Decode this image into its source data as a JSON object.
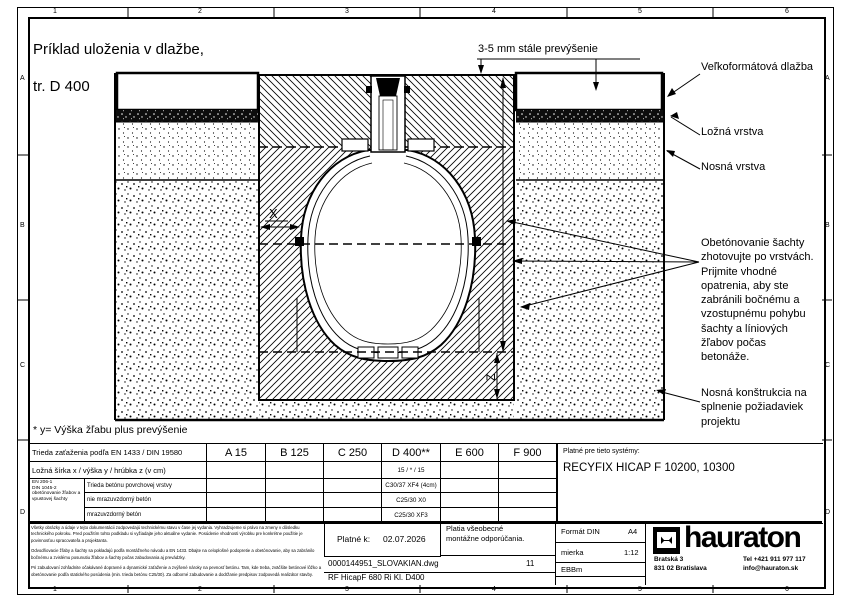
{
  "frame": {
    "cols": [
      "1",
      "2",
      "3",
      "4",
      "5",
      "6"
    ],
    "rows": [
      "A",
      "B",
      "C",
      "D"
    ]
  },
  "title": {
    "line1": "Príklad uloženia v dlažbe,",
    "line2": "tr. D 400"
  },
  "annotations": {
    "overhang": "3-5 mm stále prevýšenie",
    "paving": "Veľkoformátová dlažba",
    "bedding": "Ložná vrstva",
    "base_layer": "Nosná vrstva",
    "encasement": "Obetónovanie šachty\nzhotovujte po vrstvách.\nPrijmite vhodné\nopatrenia, aby ste\nzabránili bočnému a\nvzostupnému pohybu\nšachty a líniových\nžľabov počas\nbetonáže.",
    "substructure": "Nosná konštrukcia na\nsplnenie požiadaviek\nprojektu",
    "dim_x": "X",
    "dim_z": "Z",
    "footnote": "* y= Výška žľabu plus prevýšenie"
  },
  "table": {
    "load_class_label": "Trieda zaťaženia podľa EN 1433 / DIN 19580",
    "classes": [
      "A 15",
      "B 125",
      "C 250",
      "D 400**",
      "E 600",
      "F 900"
    ],
    "dims_label": "Ložná šírka x / výška y / hrúbka z (v cm)",
    "dims_values": [
      "",
      "",
      "",
      "15 / * / 15",
      "",
      ""
    ],
    "concrete_group": "EN 206-1\nDIN 1045-2\nobetónovanie žľabov a vpustovej šachty",
    "concrete_rows": [
      {
        "label": "Trieda betónu povrchovej vrstvy",
        "values": [
          "",
          "",
          "",
          "C30/37 XF4 (4cm)",
          "",
          ""
        ]
      },
      {
        "label": "nie mrazuvzdorný betón",
        "values": [
          "",
          "",
          "",
          "C25/30 X0",
          "",
          ""
        ]
      },
      {
        "label": "mrazuvzdorný betón",
        "values": [
          "",
          "",
          "",
          "C25/30 XF3",
          "",
          ""
        ]
      }
    ],
    "systems_label": "Platné pre tieto systémy:",
    "systems_value": "RECYFIX HICAP F  10200, 10300"
  },
  "titleblock": {
    "legal1": "Všetky obrázky a údaje v tejto dokumentácii zodpovedajú technickému stavu v čase jej vydania. Vyhradzujeme si právo na zmeny v dôsledku technického pokroku. Pred použitím tohto podkladu si vyžiadajte jeho aktuálne vydanie. Posúdenie vhodnosti výrobku pre konkrétne použitie je povinnosťou spracovateľa a projektanta.",
    "legal2": "Odvodňovacie žľaby a šachty sa pokladajú podľa montážneho návodu a EN 1433. Dbajte na celoplošné podopretie a obetónovanie, aby sa zabránilo bočnému a zvislému posunutiu žľabov a šachty počas zabudovania aj prevádzky.",
    "legal3": "Pri zabudovaní zohľadnite očakávané dopravné a dynamické zaťaženie a zvýšené nároky na pevnosť betónu. Tam, kde treba, zväčšite betónové lôžko a obetónovanie podľa statického posúdenia (min. trieda betónu C25/30). Za odborné zabudovanie a dodržanie predpisov zodpovedá realizátor stavby.",
    "valid_label": "Platné k:",
    "valid_date": "02.07.2026",
    "general_note": "Platia všeobecné\nmontážne odporúčania.",
    "file_name": "0000144951_SLOVAKIAN.dwg",
    "sheet": "11",
    "doc_name": "RF HicapF 680 Ri Kl. D400",
    "format_label": "Formát DIN",
    "format_value": "A4",
    "scale_label": "mierka",
    "scale_value": "1:12",
    "initials": "EBBm",
    "brand": "hauraton",
    "addr1": "Bratská 3",
    "addr2": "831 02 Bratislava",
    "tel": "Tel +421 911 977 117",
    "email": "info@hauraton.sk"
  },
  "colors": {
    "line": "#000000",
    "paper": "#ffffff"
  }
}
